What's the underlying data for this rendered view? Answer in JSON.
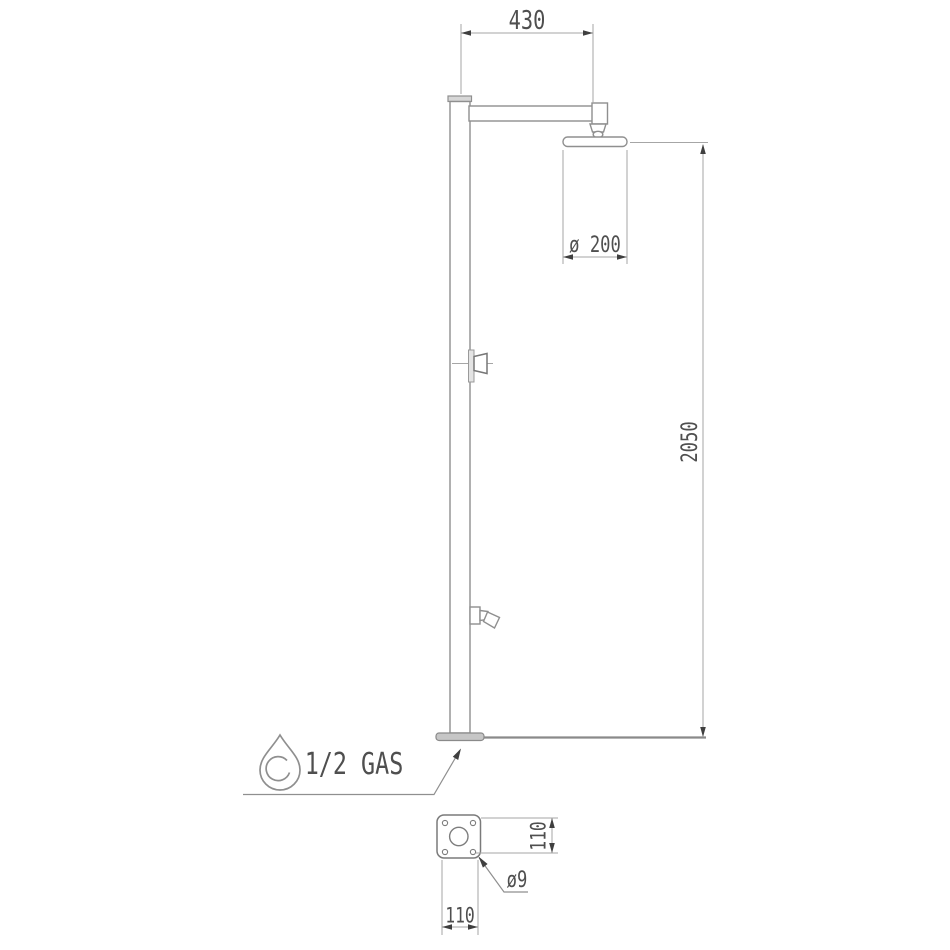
{
  "page": {
    "background": "#ffffff",
    "type": "technical-drawing",
    "subject": "shower column - front elevation and base plan"
  },
  "front_view": {
    "dim_arm_reach": "430",
    "dim_head_diameter": "ø 200",
    "dim_column_height": "2050",
    "connection_label": "1/2 GAS",
    "connection_icon": "water-drop-icon"
  },
  "base_plan": {
    "dim_plate_depth": "110",
    "dim_plate_width": "110",
    "dim_hole_diameter": "ø9"
  },
  "colors": {
    "line": "#8f8f8f",
    "arrow": "#3f3f3f",
    "text": "#4f4f4f"
  }
}
